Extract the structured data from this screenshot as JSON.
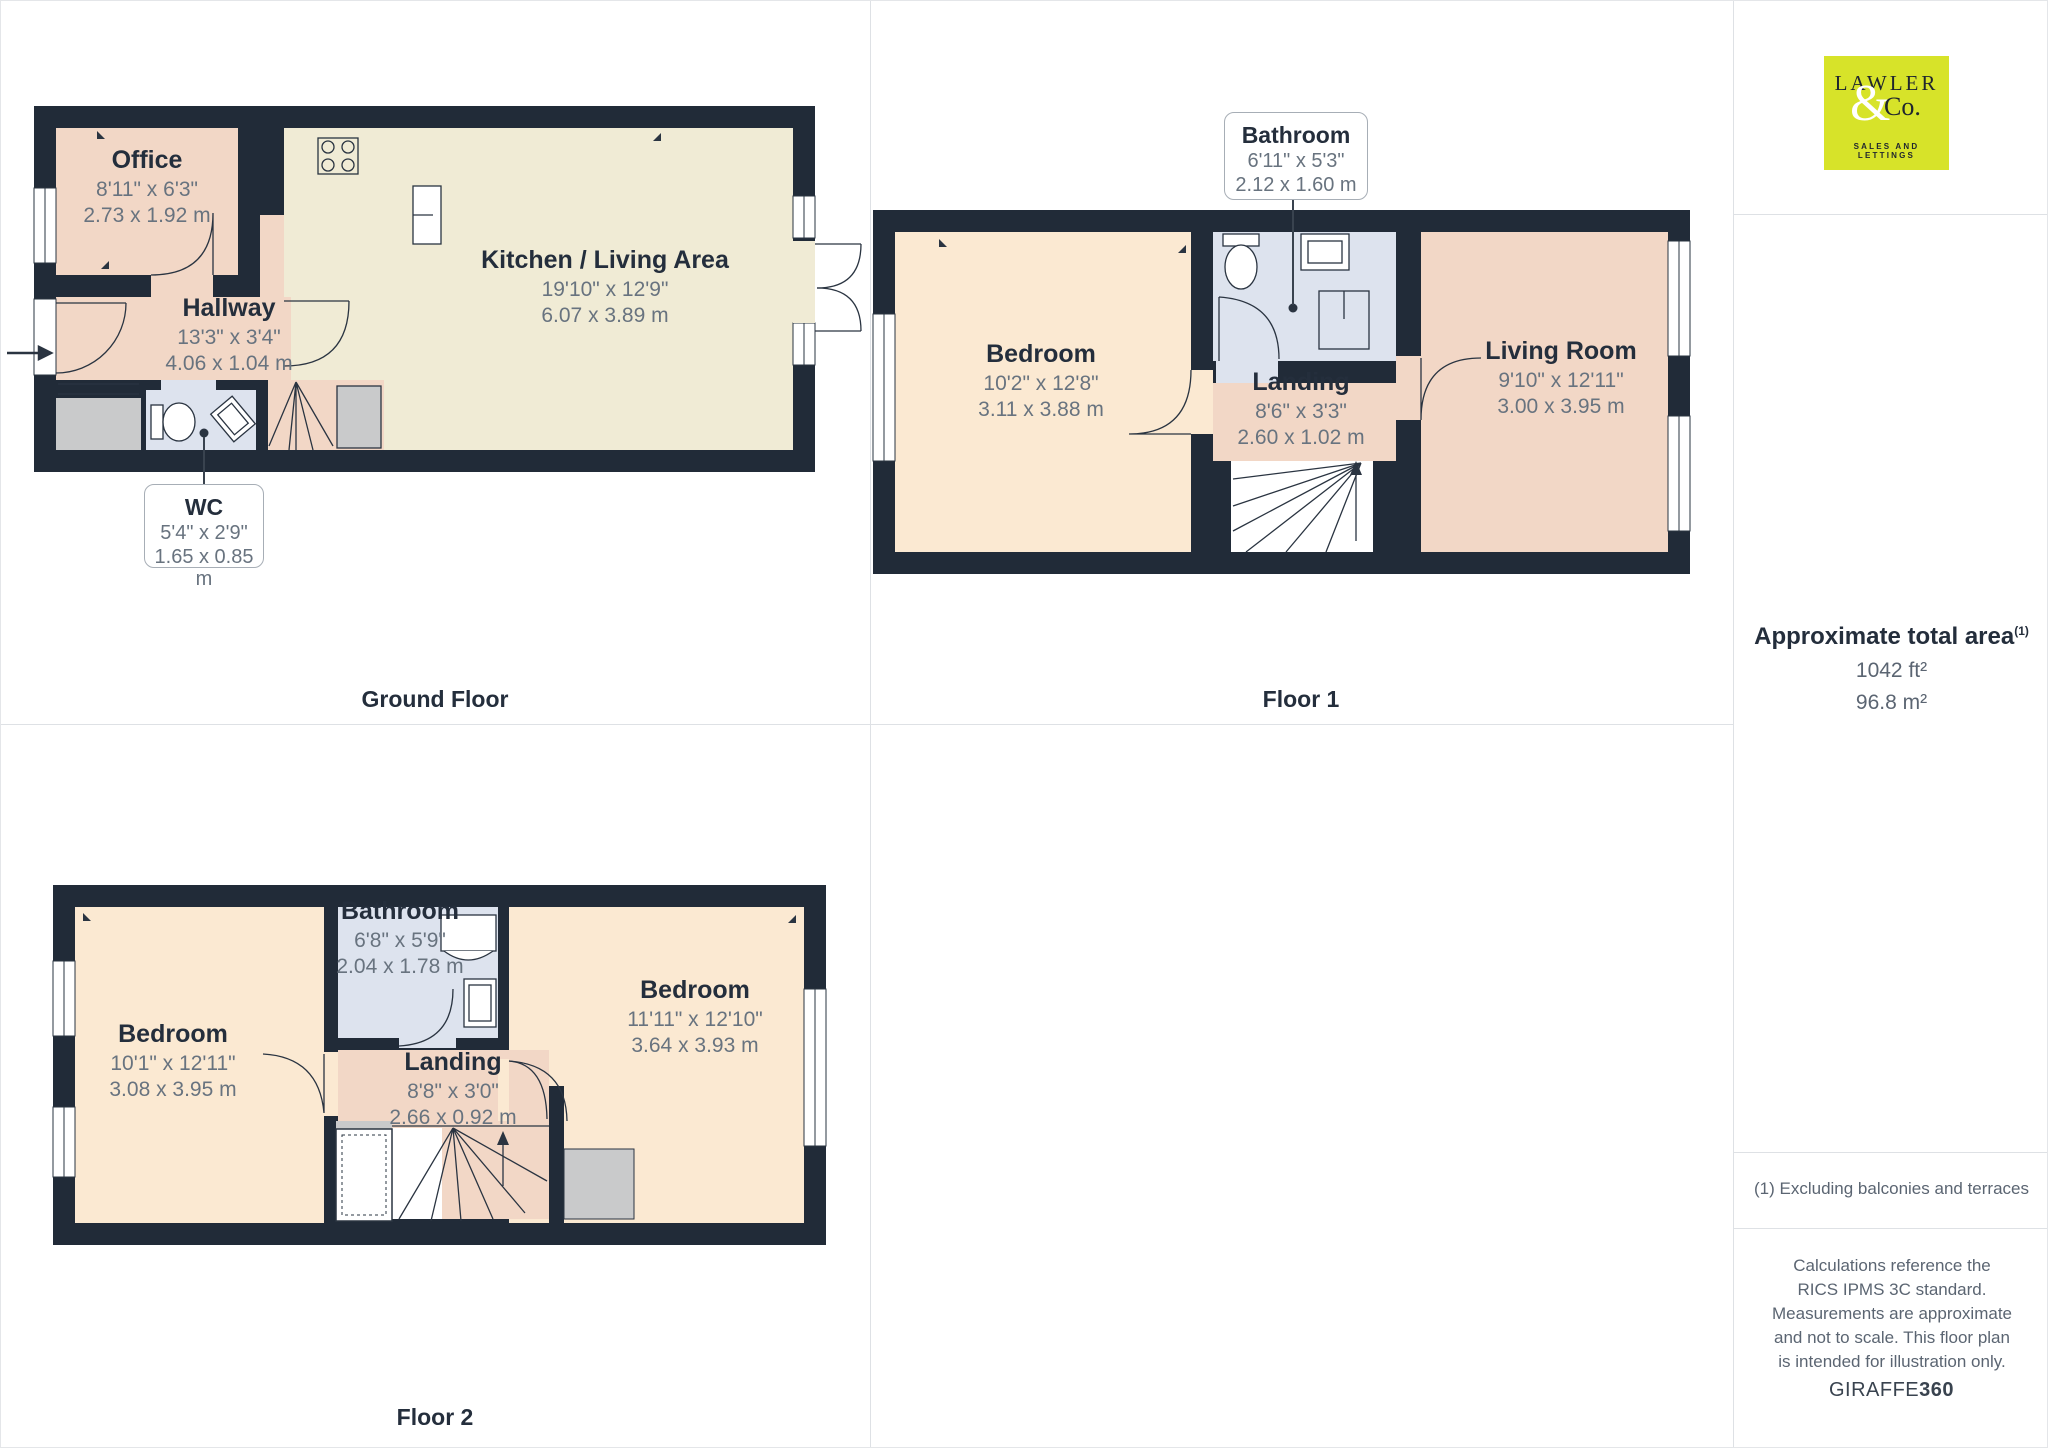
{
  "branding": {
    "logo_line1": "LAWLER",
    "logo_ampersand": "&",
    "logo_line2": "Co.",
    "logo_tagline": "SALES AND LETTINGS",
    "logo_bg_color": "#D7E329"
  },
  "sidebar": {
    "area_heading": "Approximate total area",
    "area_sup": "(1)",
    "area_ft": "1042 ft²",
    "area_m": "96.8 m²",
    "footnote": "(1) Excluding balconies and terraces",
    "disclaimer": "Calculations reference the RICS IPMS 3C standard. Measurements are approximate and not to scale. This floor plan is intended for illustration only.",
    "brand_normal": "GIRAFFE",
    "brand_bold": "360"
  },
  "colors": {
    "wall": "#212B38",
    "room_salmon": "#F2D7C6",
    "room_cream": "#F0EBD5",
    "room_peach": "#FBE9D2",
    "room_bath": "#DDE3EE",
    "room_gray": "#C9CACB",
    "line_dark": "#2A3441"
  },
  "floors": [
    {
      "label": "Ground Floor",
      "rooms": [
        {
          "name": "Office",
          "imperial": "8'11\" x 6'3\"",
          "metric": "2.73 x 1.92 m"
        },
        {
          "name": "Kitchen / Living Area",
          "imperial": "19'10\" x 12'9\"",
          "metric": "6.07 x 3.89 m"
        },
        {
          "name": "Hallway",
          "imperial": "13'3\" x 3'4\"",
          "metric": "4.06 x 1.04 m"
        },
        {
          "name": "WC",
          "imperial": "5'4\" x 2'9\"",
          "metric": "1.65 x 0.85 m"
        }
      ]
    },
    {
      "label": "Floor 1",
      "rooms": [
        {
          "name": "Bathroom",
          "imperial": "6'11\" x 5'3\"",
          "metric": "2.12 x 1.60 m"
        },
        {
          "name": "Bedroom",
          "imperial": "10'2\" x 12'8\"",
          "metric": "3.11 x 3.88 m"
        },
        {
          "name": "Landing",
          "imperial": "8'6\" x 3'3\"",
          "metric": "2.60 x 1.02 m"
        },
        {
          "name": "Living Room",
          "imperial": "9'10\" x 12'11\"",
          "metric": "3.00 x 3.95 m"
        }
      ]
    },
    {
      "label": "Floor 2",
      "rooms": [
        {
          "name": "Bedroom",
          "imperial": "10'1\" x 12'11\"",
          "metric": "3.08 x 3.95 m"
        },
        {
          "name": "Bathroom",
          "imperial": "6'8\" x 5'9\"",
          "metric": "2.04 x 1.78 m"
        },
        {
          "name": "Landing",
          "imperial": "8'8\" x 3'0\"",
          "metric": "2.66 x 0.92 m"
        },
        {
          "name": "Bedroom",
          "imperial": "11'11\" x 12'10\"",
          "metric": "3.64 x 3.93 m"
        }
      ]
    }
  ]
}
